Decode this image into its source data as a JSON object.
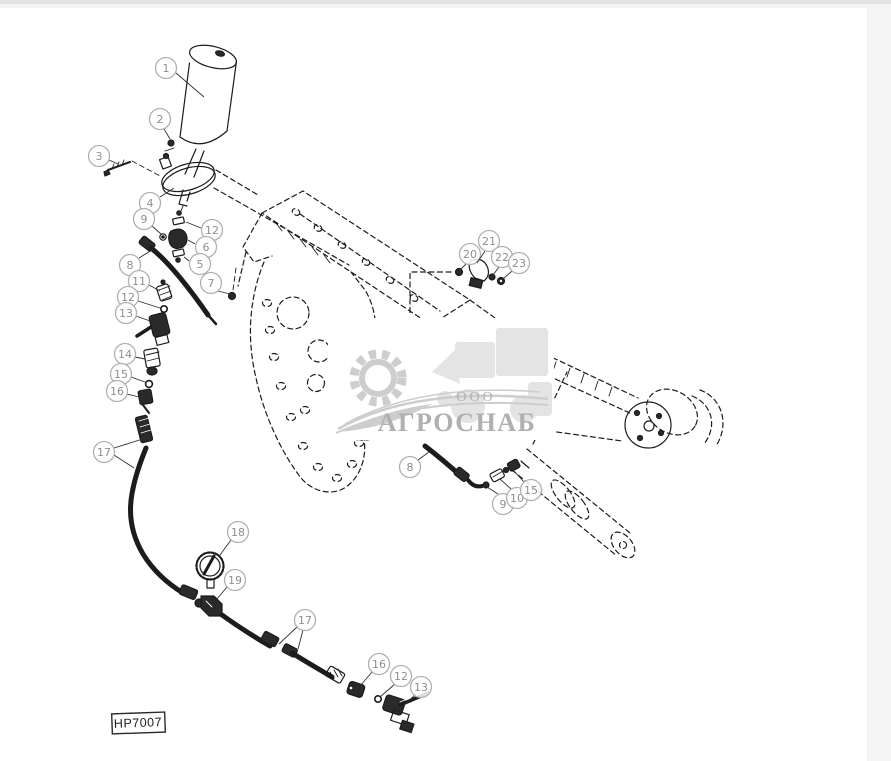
{
  "colors": {
    "line": "#1c1c1c",
    "leader": "#2f2f2f",
    "callout_ring": "#b0b0b0",
    "callout_text": "#8f8f8f",
    "watermark_text": "#b0b0b0",
    "watermark_art": "#cdcdcd",
    "watermark_faint": "#e4e4e4"
  },
  "diagram": {
    "plate_label": "HP7007",
    "watermark": {
      "prefix": "ООО",
      "name": "АГРОСНАБ"
    },
    "callouts": [
      {
        "label": "1",
        "x": 166,
        "y": 68,
        "leaders": [
          [
            176,
            73,
            204,
            97
          ]
        ]
      },
      {
        "label": "2",
        "x": 160,
        "y": 119,
        "leaders": [
          [
            164,
            129,
            170,
            139
          ]
        ]
      },
      {
        "label": "3",
        "x": 99,
        "y": 156,
        "leaders": [
          [
            109,
            160,
            118,
            164
          ]
        ]
      },
      {
        "label": "4",
        "x": 150,
        "y": 203,
        "leaders": [
          [
            160,
            197,
            174,
            188
          ]
        ]
      },
      {
        "label": "9",
        "x": 144,
        "y": 219,
        "leaders": [
          [
            152,
            226,
            161,
            234
          ]
        ]
      },
      {
        "label": "12",
        "x": 212,
        "y": 230,
        "leaders": [
          [
            201,
            228,
            186,
            222
          ]
        ]
      },
      {
        "label": "6",
        "x": 206,
        "y": 247,
        "leaders": [
          [
            195,
            244,
            188,
            240
          ]
        ]
      },
      {
        "label": "5",
        "x": 200,
        "y": 264,
        "leaders": [
          [
            189,
            261,
            184,
            257
          ]
        ]
      },
      {
        "label": "8",
        "x": 130,
        "y": 265,
        "leaders": [
          [
            139,
            258,
            152,
            250
          ]
        ]
      },
      {
        "label": "11",
        "x": 139,
        "y": 281,
        "leaders": [
          [
            149,
            285,
            160,
            291
          ]
        ]
      },
      {
        "label": "12",
        "x": 128,
        "y": 297,
        "leaders": [
          [
            138,
            301,
            160,
            308
          ]
        ]
      },
      {
        "label": "13",
        "x": 126,
        "y": 313,
        "leaders": [
          [
            136,
            316,
            150,
            321
          ]
        ]
      },
      {
        "label": "7",
        "x": 211,
        "y": 283,
        "leaders": [
          [
            218,
            291,
            230,
            294
          ]
        ]
      },
      {
        "label": "14",
        "x": 125,
        "y": 354,
        "leaders": [
          [
            135,
            357,
            145,
            359
          ]
        ]
      },
      {
        "label": "15",
        "x": 121,
        "y": 374,
        "leaders": [
          [
            131,
            377,
            145,
            382
          ]
        ]
      },
      {
        "label": "16",
        "x": 117,
        "y": 391,
        "leaders": [
          [
            127,
            394,
            139,
            397
          ]
        ]
      },
      {
        "label": "17",
        "x": 104,
        "y": 452,
        "leaders": [
          [
            114,
            448,
            149,
            437
          ],
          [
            114,
            455,
            134,
            468
          ]
        ]
      },
      {
        "label": "18",
        "x": 238,
        "y": 532,
        "leaders": [
          [
            231,
            540,
            220,
            555
          ]
        ]
      },
      {
        "label": "19",
        "x": 235,
        "y": 580,
        "leaders": [
          [
            227,
            587,
            217,
            599
          ]
        ]
      },
      {
        "label": "17",
        "x": 305,
        "y": 620,
        "leaders": [
          [
            297,
            627,
            279,
            644
          ],
          [
            303,
            630,
            298,
            649
          ]
        ]
      },
      {
        "label": "16",
        "x": 379,
        "y": 664,
        "leaders": [
          [
            372,
            672,
            360,
            686
          ]
        ]
      },
      {
        "label": "12",
        "x": 401,
        "y": 676,
        "leaders": [
          [
            395,
            684,
            380,
            697
          ]
        ]
      },
      {
        "label": "13",
        "x": 421,
        "y": 687,
        "leaders": [
          [
            415,
            695,
            404,
            705
          ]
        ]
      },
      {
        "label": "20",
        "x": 470,
        "y": 254,
        "leaders": [
          [
            466,
            264,
            460,
            270
          ]
        ]
      },
      {
        "label": "21",
        "x": 489,
        "y": 241,
        "leaders": [
          [
            485,
            251,
            477,
            263
          ]
        ]
      },
      {
        "label": "22",
        "x": 502,
        "y": 257,
        "leaders": [
          [
            499,
            267,
            493,
            275
          ]
        ]
      },
      {
        "label": "23",
        "x": 519,
        "y": 263,
        "leaders": [
          [
            512,
            271,
            503,
            279
          ]
        ]
      },
      {
        "label": "8",
        "x": 410,
        "y": 467,
        "leaders": [
          [
            418,
            460,
            429,
            452
          ]
        ]
      },
      {
        "label": "9",
        "x": 503,
        "y": 504,
        "leaders": [
          [
            498,
            494,
            487,
            487
          ]
        ]
      },
      {
        "label": "10",
        "x": 517,
        "y": 498,
        "leaders": [
          [
            511,
            489,
            500,
            479
          ]
        ]
      },
      {
        "label": "15",
        "x": 531,
        "y": 490,
        "leaders": [
          [
            524,
            482,
            514,
            471
          ]
        ]
      }
    ]
  }
}
